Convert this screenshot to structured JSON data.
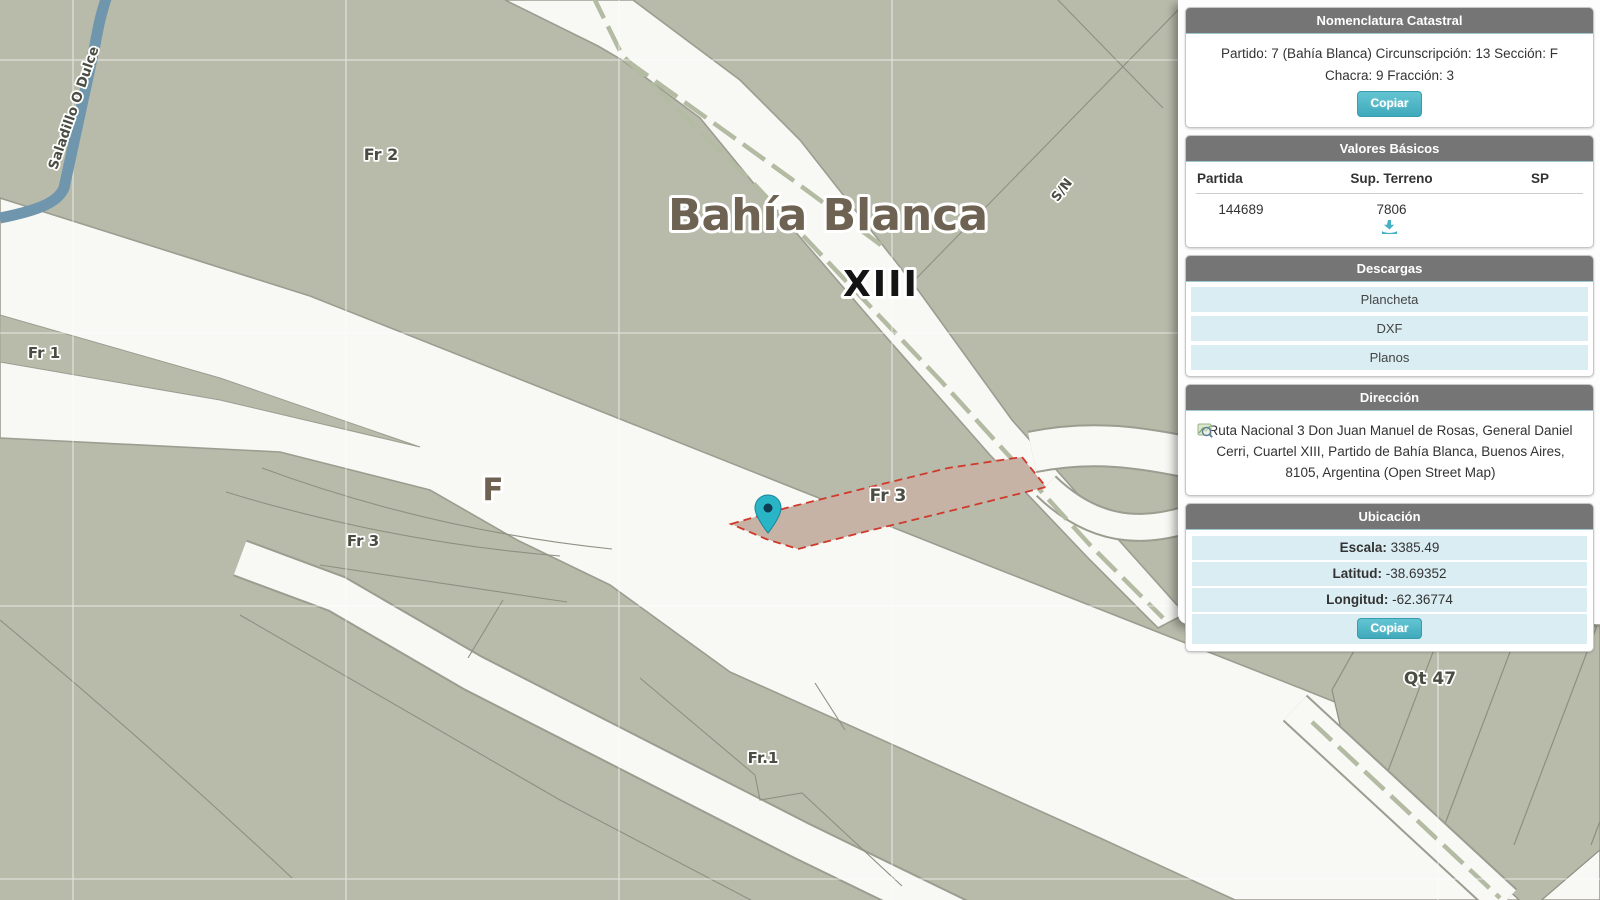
{
  "colors": {
    "accent": "#45b2c4",
    "header-gray": "#757575",
    "cyan-row": "#d9edf2",
    "map-bg": "#b8bbaa",
    "road": "#f8f8f5",
    "casing": "#9c9c90",
    "boundary": "#8d9080",
    "river": "#6f96ac",
    "parcel-fill": "#c7b2a6",
    "parcel-stroke": "#cf3a2c",
    "label-brown": "#6e6352"
  },
  "map": {
    "labels": {
      "city": "Bahía Blanca",
      "cuartel": "XIII",
      "section": "F",
      "fr2": "Fr 2",
      "fr1": "Fr 1",
      "fr3_median": "Fr 3",
      "fr3_parcel": "Fr 3",
      "fr1_south": "Fr.1",
      "qt47": "Qt 47",
      "sn": "S/N",
      "river": "Saladillo O Dulce"
    }
  },
  "panel": {
    "nomenclatura": {
      "title": "Nomenclatura Catastral",
      "line1": "Partido: 7 (Bahía Blanca) Circunscripción: 13 Sección: F",
      "line2": "Chacra: 9 Fracción: 3",
      "copy_label": "Copiar"
    },
    "valores": {
      "title": "Valores Básicos",
      "columns": [
        "Partida",
        "Sup. Terreno",
        "SP"
      ],
      "row": {
        "partida": "144689",
        "sup_terreno": "7806",
        "sp": ""
      }
    },
    "descargas": {
      "title": "Descargas",
      "items": [
        "Plancheta",
        "DXF",
        "Planos"
      ]
    },
    "direccion": {
      "title": "Dirección",
      "text": "Ruta Nacional 3 Don Juan Manuel de Rosas, General Daniel Cerri, Cuartel XIII, Partido de Bahía Blanca, Buenos Aires, 8105, Argentina (Open Street Map)"
    },
    "ubicacion": {
      "title": "Ubicación",
      "rows": [
        {
          "label": "Escala:",
          "value": " 3385.49"
        },
        {
          "label": "Latitud:",
          "value": " -38.69352"
        },
        {
          "label": "Longitud:",
          "value": " -62.36774"
        }
      ],
      "copy_label": "Copiar"
    }
  }
}
